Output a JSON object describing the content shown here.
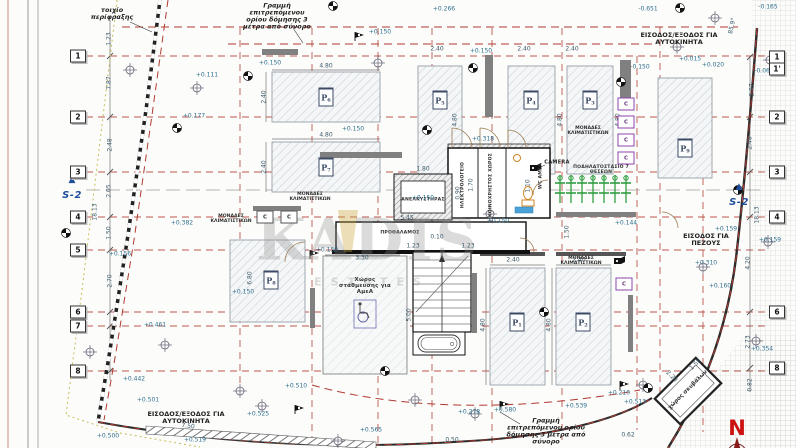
{
  "annotations": {
    "fence_wall": "τοιχίο περίφραξης",
    "building_limit": "Γραμμή επιτρεπόμενου ορίου δόμησης 3 μέτρα από σύνορο",
    "car_entrance": "ΕΙΣΟΔΟΣ/ΕΞΟΔΟΣ ΓΙΑ ΑΥΤΟΚΙΝΗΤΑ",
    "pedestrian_entrance": "ΕΙΣΟΔΟΣ ΓΙΑ ΠΕΖΟΥΣ",
    "elevator": "ΑΝΕΛΚΥΣΤΗΡΑΣ",
    "vestibule": "ΠΡΟΘΑΛΑΜΟΣ",
    "electrical_room": "ΗΛΕΚΤΡΟΛΟΓΕΙΟ",
    "common_space": "ΚΟΙΝΟΧΡΗΣΤΟΣ ΧΩΡΟΣ",
    "wc_disabled": "WC ΑΜΕΑ",
    "disabled_parking": "Χώρος στάθμευσης για ΑμεΑ",
    "bike_parking": "ΠΟΔΗΛΑΤΟΣΤΑΣΙΟ 7 ΘΕΣΕΩΝ",
    "camera": "CAMERA",
    "garbage_room": "χώρος σκυβάλων",
    "ac_units": "ΜΟΝΑΔΕΣ ΚΛΙΜΑΤΙΣΤΙΚΩΝ",
    "angle_note": "85.9°"
  },
  "watermark": {
    "name": "KADIS",
    "sub": "ESTATES"
  },
  "compass": {
    "north": "N"
  },
  "section_marker": {
    "label": "S-2",
    "triangle": "▲"
  },
  "ac_positions": [
    [
      588,
      131
    ],
    [
      310,
      197
    ],
    [
      231,
      219
    ],
    [
      581,
      261
    ]
  ],
  "c_unit_label": "C",
  "c_units": [
    [
      265,
      217,
      "d"
    ],
    [
      289,
      217,
      "d"
    ],
    [
      626,
      104,
      "p"
    ],
    [
      626,
      122,
      "p"
    ],
    [
      626,
      140,
      "p"
    ],
    [
      626,
      158,
      "p"
    ],
    [
      624,
      284,
      "p"
    ]
  ],
  "grid": {
    "left_x": 78,
    "right_x": 777,
    "left": [
      [
        "1",
        56
      ],
      [
        "2",
        117
      ],
      [
        "3",
        172
      ],
      [
        "4",
        217
      ],
      [
        "5",
        250
      ],
      [
        "6",
        312
      ],
      [
        "7",
        326
      ],
      [
        "8",
        371
      ]
    ],
    "right": [
      [
        "1",
        57
      ],
      [
        "1'",
        69
      ],
      [
        "2",
        117
      ],
      [
        "3",
        172
      ],
      [
        "4",
        217
      ],
      [
        "6",
        312
      ],
      [
        "8",
        368
      ]
    ]
  },
  "parking": {
    "prefix": "P",
    "spaces": [
      [
        "6",
        326,
        97
      ],
      [
        "7",
        326,
        167
      ],
      [
        "5",
        440,
        100
      ],
      [
        "4",
        531,
        100
      ],
      [
        "3",
        590,
        100
      ],
      [
        "9",
        685,
        148
      ],
      [
        "8",
        271,
        280
      ],
      [
        "1",
        517,
        322
      ],
      [
        "2",
        583,
        322
      ]
    ]
  },
  "dim_labels": [
    [
      "4.80",
      326,
      67,
      0
    ],
    [
      "2.40",
      265,
      97,
      -90
    ],
    [
      "4.80",
      326,
      136,
      0
    ],
    [
      "2.40",
      265,
      167,
      -90
    ],
    [
      "2.40",
      437,
      50,
      0
    ],
    [
      "2.40",
      524,
      50,
      0
    ],
    [
      "2.40",
      572,
      50,
      0
    ],
    [
      "4.80",
      456,
      120,
      -90
    ],
    [
      "4.80",
      561,
      120,
      -90
    ],
    [
      "4.80",
      619,
      120,
      -90
    ],
    [
      "2.40",
      513,
      261,
      0
    ],
    [
      "2.40",
      579,
      261,
      0
    ],
    [
      "4.80",
      484,
      325,
      -90
    ],
    [
      "4.80",
      550,
      325,
      -90
    ],
    [
      "3.30",
      362,
      259,
      0
    ],
    [
      "5.00",
      410,
      315,
      -90
    ],
    [
      "6.80",
      251,
      278,
      -90
    ],
    [
      "1.80",
      423,
      170,
      0
    ],
    [
      "5.45",
      407,
      219,
      0
    ],
    [
      "0.10",
      437,
      238,
      0
    ],
    [
      "1.23",
      413,
      247,
      0
    ],
    [
      "1.23",
      468,
      247,
      0
    ],
    [
      "0.90",
      459,
      193,
      -90
    ],
    [
      "1.70",
      472,
      185,
      -90
    ],
    [
      "1.10",
      529,
      186,
      -90
    ],
    [
      "1.50",
      568,
      232,
      -90
    ],
    [
      "1.23",
      110,
      39,
      -90
    ],
    [
      "7.87",
      110,
      83,
      -90
    ],
    [
      "2.48",
      111,
      145,
      -90
    ],
    [
      "2.05",
      110,
      191,
      -90
    ],
    [
      "1.50",
      110,
      233,
      -90
    ],
    [
      "18.13",
      96,
      212,
      -90
    ],
    [
      "2.70",
      111,
      281,
      -90
    ],
    [
      "2.87",
      753,
      90,
      -90
    ],
    [
      "2.48",
      751,
      143,
      -90
    ],
    [
      "18.13",
      758,
      215,
      -90
    ],
    [
      "4.20",
      749,
      263,
      -90
    ],
    [
      "2.73",
      749,
      342,
      -90
    ],
    [
      "0.82",
      751,
      385,
      -90
    ],
    [
      "7.50",
      188,
      427,
      6
    ],
    [
      "0.50",
      452,
      441,
      0
    ],
    [
      "0.62",
      628,
      436,
      0
    ],
    [
      "1.55",
      696,
      365,
      -45
    ],
    [
      "2.20",
      671,
      377,
      45
    ],
    [
      "85.9°",
      733,
      26,
      -78
    ]
  ],
  "elev_labels": [
    [
      "-0.651",
      648,
      10
    ],
    [
      "-0.165",
      768,
      8
    ],
    [
      "+0.266",
      444,
      10
    ],
    [
      "+0.150",
      270,
      64
    ],
    [
      "+0.150",
      380,
      33
    ],
    [
      "+0.150",
      481,
      52
    ],
    [
      "-0.150",
      640,
      68
    ],
    [
      "+0.015",
      690,
      60
    ],
    [
      "+0.020",
      713,
      66
    ],
    [
      "-0.062",
      764,
      72
    ],
    [
      "+0.111",
      207,
      76
    ],
    [
      "+0.177",
      194,
      117
    ],
    [
      "+0.150",
      353,
      130
    ],
    [
      "+0.318",
      483,
      140
    ],
    [
      "+0.382",
      182,
      224
    ],
    [
      "+0.150",
      423,
      199
    ],
    [
      "+0.150",
      327,
      251
    ],
    [
      "+0.150",
      498,
      222
    ],
    [
      "+0.144",
      626,
      224
    ],
    [
      "+0.150",
      243,
      293
    ],
    [
      "+0.159",
      726,
      230
    ],
    [
      "+0.159",
      770,
      241
    ],
    [
      "+0.310",
      706,
      264
    ],
    [
      "+0.160",
      720,
      287
    ],
    [
      "+0.354",
      762,
      350
    ],
    [
      "+0.461",
      155,
      326
    ],
    [
      "+0.442",
      134,
      380
    ],
    [
      "+0.501",
      148,
      401
    ],
    [
      "+0.156",
      120,
      255
    ],
    [
      "+0.510",
      296,
      387
    ],
    [
      "+0.525",
      258,
      415
    ],
    [
      "+0.519",
      195,
      441
    ],
    [
      "+0.565",
      371,
      431
    ],
    [
      "+0.500",
      108,
      437
    ],
    [
      "+0.278",
      469,
      413
    ],
    [
      "+0.580",
      505,
      411
    ],
    [
      "+0.539",
      576,
      407
    ],
    [
      "+0.210",
      619,
      394
    ],
    [
      "+0.513",
      635,
      403
    ]
  ],
  "symbols": {
    "benchmarks": [
      [
        130,
        70
      ],
      [
        197,
        88
      ],
      [
        378,
        63
      ],
      [
        715,
        18
      ],
      [
        677,
        47
      ],
      [
        770,
        60
      ],
      [
        490,
        214
      ],
      [
        165,
        345
      ],
      [
        90,
        352
      ],
      [
        240,
        391
      ],
      [
        415,
        400
      ],
      [
        475,
        414
      ],
      [
        643,
        385
      ],
      [
        768,
        242
      ],
      [
        703,
        267
      ],
      [
        756,
        341
      ],
      [
        338,
        441
      ],
      [
        262,
        406
      ]
    ],
    "survey_points": [
      [
        333,
        6
      ],
      [
        248,
        76
      ],
      [
        177,
        128
      ],
      [
        473,
        68
      ],
      [
        621,
        82
      ],
      [
        427,
        130
      ],
      [
        66,
        233
      ],
      [
        385,
        371
      ],
      [
        648,
        388
      ],
      [
        738,
        190
      ],
      [
        680,
        8
      ],
      [
        544,
        312
      ]
    ],
    "flags": [
      [
        355,
        41
      ],
      [
        310,
        259
      ],
      [
        295,
        414
      ],
      [
        500,
        410
      ],
      [
        620,
        390
      ]
    ],
    "cameras": [
      [
        534,
        168
      ],
      [
        618,
        261
      ]
    ],
    "bikes_x": [
      560,
      571,
      582,
      593,
      604,
      615,
      626
    ],
    "bikes_y": 190
  }
}
